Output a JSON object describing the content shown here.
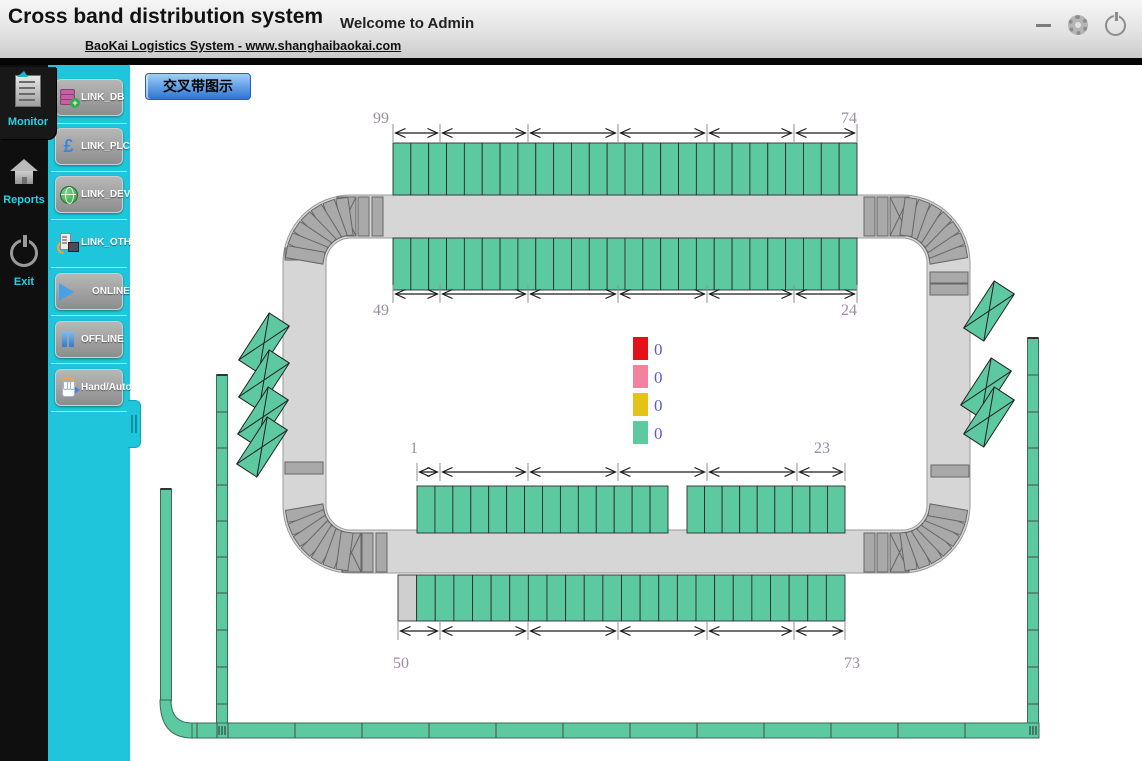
{
  "header": {
    "title": "Cross band distribution system",
    "subtitle": "BaoKai Logistics System - www.shanghaibaokai.com",
    "welcome": "Welcome to Admin"
  },
  "sidebar": {
    "items": [
      {
        "id": "monitor",
        "label": "Monitor",
        "active": true
      },
      {
        "id": "reports",
        "label": "Reports",
        "active": false
      },
      {
        "id": "exit",
        "label": "Exit",
        "active": false
      }
    ]
  },
  "toolbox": {
    "buttons": [
      {
        "id": "link_db",
        "label": "LINK_DB",
        "icon": "database-icon",
        "flat": false
      },
      {
        "id": "link_plc",
        "label": "LINK_PLC",
        "icon": "plc-icon",
        "flat": false
      },
      {
        "id": "link_dev",
        "label": "LINK_DEV",
        "icon": "globe-icon",
        "flat": false
      },
      {
        "id": "link_oth",
        "label": "LINK_OTH",
        "icon": "device-icon",
        "flat": true
      },
      {
        "id": "online",
        "label": "ONLINE",
        "icon": "play-icon",
        "flat": false
      },
      {
        "id": "offline",
        "label": "OFFLINE",
        "icon": "pause-icon",
        "flat": false
      },
      {
        "id": "hand_auto",
        "label": "Hand/Auto",
        "icon": "hand-icon",
        "flat": false
      }
    ]
  },
  "view_tab": {
    "label": "交叉带图示"
  },
  "legend": {
    "x": 633,
    "y": 337,
    "swatch_w": 15,
    "swatch_h": 23,
    "step": 28,
    "text_color": "#5a5ad2",
    "items": [
      {
        "color": "#e31118",
        "value": "0"
      },
      {
        "color": "#f2839e",
        "value": "0"
      },
      {
        "color": "#e5c217",
        "value": "0"
      },
      {
        "color": "#5dc9a1",
        "value": "0"
      }
    ]
  },
  "diagram": {
    "colors": {
      "cell": "#5dc9a1",
      "cell_border": "#2e2e2e",
      "cell_gray": "#cfcfcf",
      "track": "#d6d6d6",
      "track_border": "#9a9a9a",
      "slat": "#a9a9a9",
      "slat_border": "#666666",
      "belt": "#5dc9a1",
      "belt_border": "#3c6a58",
      "label": "#9c8ca2",
      "arrow": "#1a1a1a",
      "tick": "#909090"
    },
    "ring": {
      "x": 283,
      "y": 195,
      "w": 687,
      "h": 378,
      "band": 43,
      "r": 68
    },
    "rows": [
      {
        "name": "top-outer",
        "y": 143,
        "h": 52,
        "groups": [
          {
            "x": 393,
            "w": 464,
            "cells": 26
          }
        ],
        "ticks": [
          393,
          440,
          528,
          618,
          707,
          794,
          857
        ],
        "arrow_y": 133,
        "labels": [
          {
            "t": "99",
            "x": 381,
            "y": 123
          },
          {
            "t": "74",
            "x": 849,
            "y": 123
          }
        ]
      },
      {
        "name": "top-inner",
        "y": 238,
        "h": 52,
        "groups": [
          {
            "x": 393,
            "w": 464,
            "cells": 26
          }
        ],
        "ticks": [
          393,
          440,
          528,
          618,
          707,
          794,
          857
        ],
        "arrow_y": 294,
        "labels": [
          {
            "t": "49",
            "x": 381,
            "y": 315
          },
          {
            "t": "24",
            "x": 849,
            "y": 315
          }
        ]
      },
      {
        "name": "middle",
        "y": 486,
        "h": 47,
        "groups": [
          {
            "x": 417,
            "w": 251,
            "cells": 14
          },
          {
            "x": 687,
            "w": 158,
            "cells": 9
          }
        ],
        "ticks": [
          417,
          440,
          528,
          618,
          707,
          797,
          845
        ],
        "arrow_y": 472,
        "labels": [
          {
            "t": "1",
            "x": 414,
            "y": 453
          },
          {
            "t": "23",
            "x": 822,
            "y": 453
          }
        ]
      },
      {
        "name": "bottom",
        "y": 575,
        "h": 46,
        "groups": [
          {
            "x": 398,
            "w": 447,
            "cells": 24,
            "gray_first": true
          }
        ],
        "ticks": [
          398,
          440,
          528,
          618,
          707,
          794,
          845
        ],
        "arrow_y": 631,
        "labels": [
          {
            "t": "50",
            "x": 401,
            "y": 668
          },
          {
            "t": "73",
            "x": 852,
            "y": 668
          }
        ]
      }
    ],
    "corners": [
      {
        "name": "top-left",
        "cx": 351,
        "cy": 263,
        "fan": [
          98,
          110,
          122,
          134,
          146,
          158,
          170
        ],
        "slats": [
          [
            358,
            197,
            11,
            39
          ],
          [
            372,
            197,
            11,
            39
          ]
        ],
        "x_slat": [
          337,
          197,
          19,
          39
        ],
        "side_slats": [
          [
            285,
            248,
            38,
            12
          ]
        ]
      },
      {
        "name": "top-right",
        "cx": 902,
        "cy": 263,
        "fan": [
          10,
          22,
          34,
          46,
          58,
          70,
          82
        ],
        "slats": [
          [
            864,
            197,
            11,
            39
          ],
          [
            877,
            197,
            11,
            39
          ]
        ],
        "x_slat": [
          890,
          197,
          19,
          39
        ],
        "side_slats": [
          [
            930,
            272,
            38,
            11
          ],
          [
            930,
            284,
            38,
            11
          ]
        ]
      },
      {
        "name": "bottom-left",
        "cx": 351,
        "cy": 505,
        "fan": [
          190,
          202,
          214,
          226,
          238,
          250,
          262
        ],
        "slats": [
          [
            362,
            533,
            11,
            39
          ],
          [
            376,
            533,
            11,
            39
          ]
        ],
        "x_slat": [
          342,
          533,
          19,
          39
        ],
        "side_slats": [
          [
            285,
            462,
            38,
            12
          ]
        ]
      },
      {
        "name": "bottom-right",
        "cx": 902,
        "cy": 505,
        "fan": [
          278,
          290,
          302,
          314,
          326,
          338,
          350
        ],
        "slats": [
          [
            864,
            533,
            11,
            39
          ],
          [
            877,
            533,
            11,
            39
          ]
        ],
        "x_slat": [
          890,
          533,
          19,
          39
        ],
        "side_slats": [
          [
            931,
            465,
            38,
            12
          ]
        ]
      }
    ],
    "fan_radius": 46.5,
    "fan_slat": {
      "len": 38,
      "w": 12
    },
    "chutes": [
      {
        "cx": 264,
        "cy": 343
      },
      {
        "cx": 264,
        "cy": 380
      },
      {
        "cx": 263,
        "cy": 417
      },
      {
        "cx": 262,
        "cy": 447
      },
      {
        "cx": 989,
        "cy": 311
      },
      {
        "cx": 986,
        "cy": 388
      },
      {
        "cx": 989,
        "cy": 417
      }
    ],
    "chute_size": {
      "l": 56,
      "w": 24,
      "angle": -57
    },
    "strips": [
      {
        "x": 160.5,
        "y": 489,
        "w": 11,
        "h": 212,
        "dividers": []
      },
      {
        "x": 216.5,
        "y": 375,
        "w": 11,
        "h": 348,
        "dividers": [
          412,
          448,
          485,
          521,
          557,
          593,
          630,
          667,
          704
        ]
      },
      {
        "x": 1027.5,
        "y": 338,
        "w": 11,
        "h": 385,
        "dividers": [
          375,
          412,
          448,
          485,
          521,
          557,
          593,
          630,
          667,
          704
        ]
      }
    ],
    "belt": {
      "x": 192,
      "y": 723,
      "w": 847,
      "h": 15,
      "dividers": [
        197,
        217,
        228,
        295,
        362,
        429,
        496,
        563,
        630,
        697,
        764,
        831,
        898,
        965
      ],
      "junctions": [
        222,
        1033
      ]
    },
    "corner_path": "M160,700 Q160,738 192,738 L192,723 Q171,723 171,700 Z"
  }
}
